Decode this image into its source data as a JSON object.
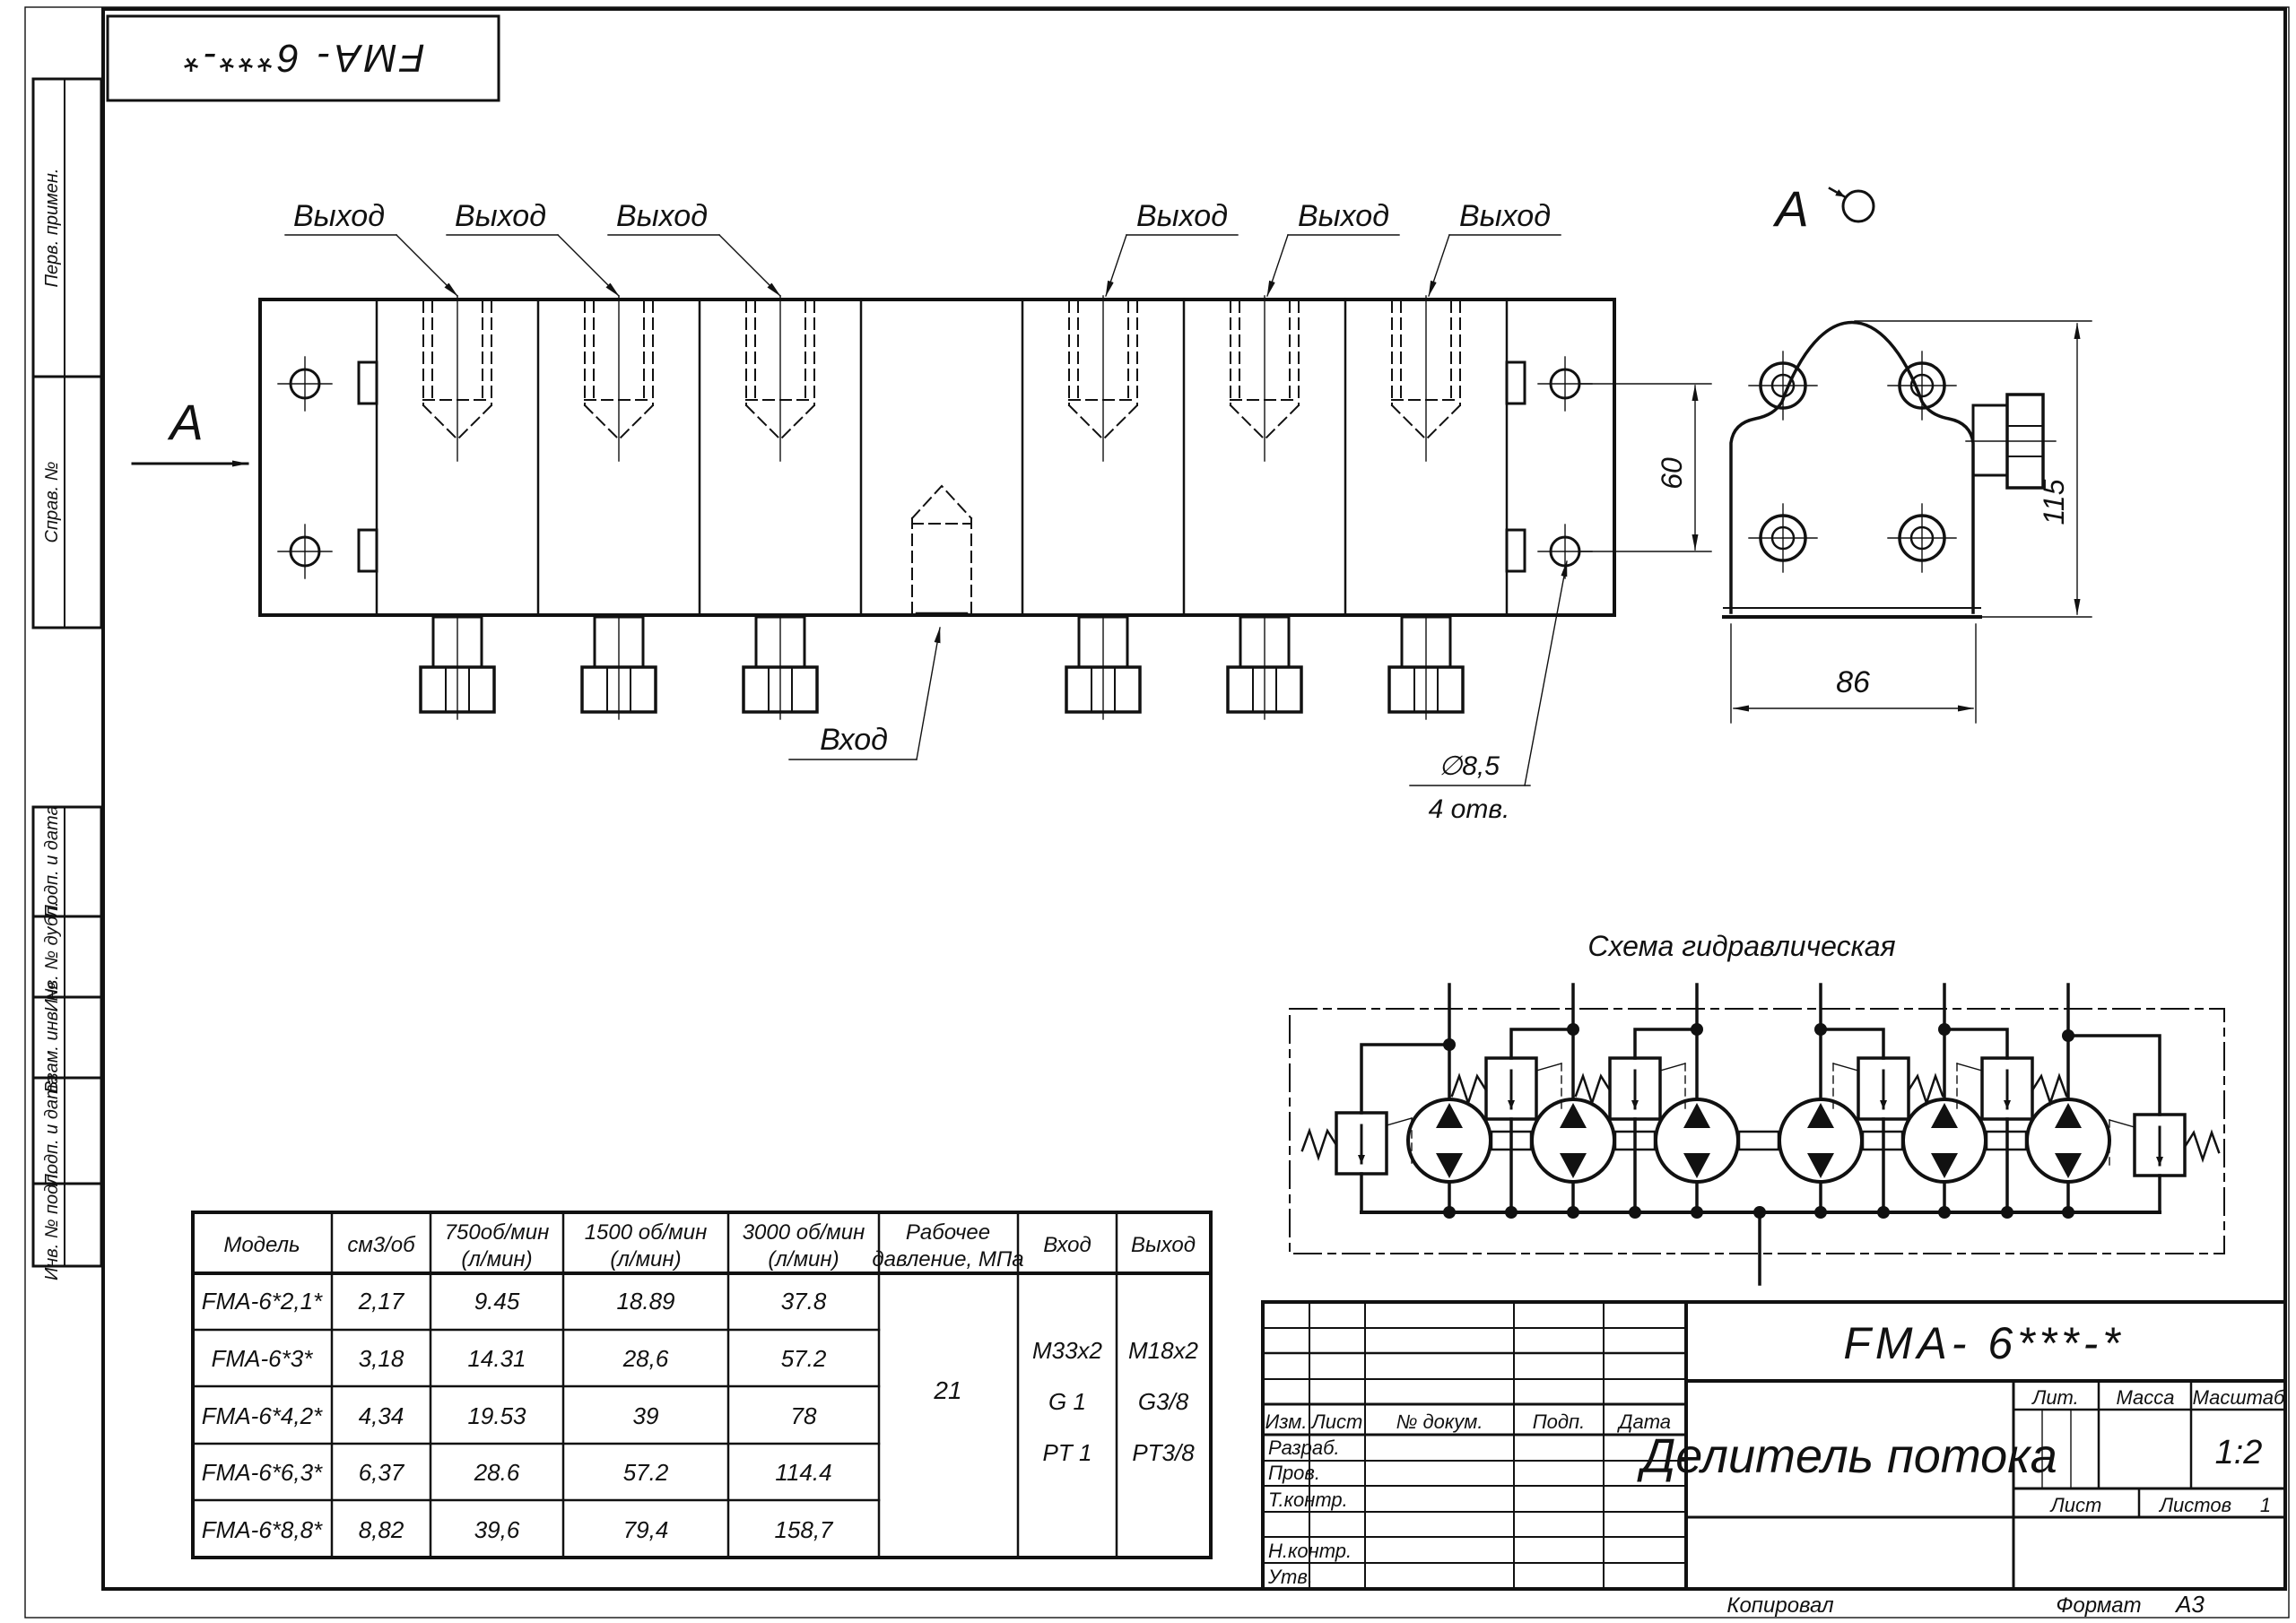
{
  "sheet": {
    "top_designation": "FMA- 6***-*",
    "margin_labels": {
      "perv": "Перв. примен.",
      "sprav": "Справ. №",
      "podp1": "Подп. и дата",
      "inv_dubl": "Инв. № дубл.",
      "vzam": "Взам. инв. №",
      "podp2": "Подп. и дата",
      "inv_podl": "Инв. № подл."
    },
    "footer": {
      "kopiroval": "Копировал",
      "format_label": "Формат",
      "format_value": "А3"
    }
  },
  "views": {
    "front": {
      "output_label": "Выход",
      "input_label": "Вход",
      "view_letter": "А",
      "dim_60": "60",
      "hole_dia": "∅8,5",
      "hole_count": "4 отв."
    },
    "side": {
      "view_letter": "А",
      "dim_115": "115",
      "dim_86": "86"
    }
  },
  "schematic": {
    "title": "Схема гидравлическая"
  },
  "table": {
    "headers": {
      "model": "Модель",
      "cm3": "см3/об",
      "r750_1": "750об/мин",
      "r750_2": "(л/мин)",
      "r1500_1": "1500 об/мин",
      "r1500_2": "(л/мин)",
      "r3000_1": "3000 об/мин",
      "r3000_2": "(л/мин)",
      "pres_1": "Рабочее",
      "pres_2": "давление, МПа",
      "inlet": "Вход",
      "outlet": "Выход"
    },
    "rows": [
      {
        "model": "FMA-6*2,1*",
        "cm3": "2,17",
        "q750": "9.45",
        "q1500": "18.89",
        "q3000": "37.8"
      },
      {
        "model": "FMA-6*3*",
        "cm3": "3,18",
        "q750": "14.31",
        "q1500": "28,6",
        "q3000": "57.2"
      },
      {
        "model": "FMA-6*4,2*",
        "cm3": "4,34",
        "q750": "19.53",
        "q1500": "39",
        "q3000": "78"
      },
      {
        "model": "FMA-6*6,3*",
        "cm3": "6,37",
        "q750": "28.6",
        "q1500": "57.2",
        "q3000": "114.4"
      },
      {
        "model": "FMA-6*8,8*",
        "cm3": "8,82",
        "q750": "39,6",
        "q1500": "79,4",
        "q3000": "158,7"
      }
    ],
    "pressure": "21",
    "inlet": [
      "M33x2",
      "G 1",
      "PT 1"
    ],
    "outlet": [
      "M18x2",
      "G3/8",
      "PT3/8"
    ]
  },
  "title_block": {
    "designation": "FMA- 6***-*",
    "name": "Делитель потока",
    "cols": {
      "izm": "Изм.",
      "list": "Лист",
      "ndok": "№ докум.",
      "podp": "Подп.",
      "data": "Дата"
    },
    "rows": {
      "razrab": "Разраб.",
      "prov": "Пров.",
      "tkontr": "Т.контр.",
      "nkontr": "Н.контр.",
      "utv": "Утв."
    },
    "lit": "Лит.",
    "massa": "Масса",
    "masshtab": "Масштаб",
    "scale": "1:2",
    "sheet_label": "Лист",
    "sheets_label": "Листов",
    "sheets_value": "1"
  }
}
